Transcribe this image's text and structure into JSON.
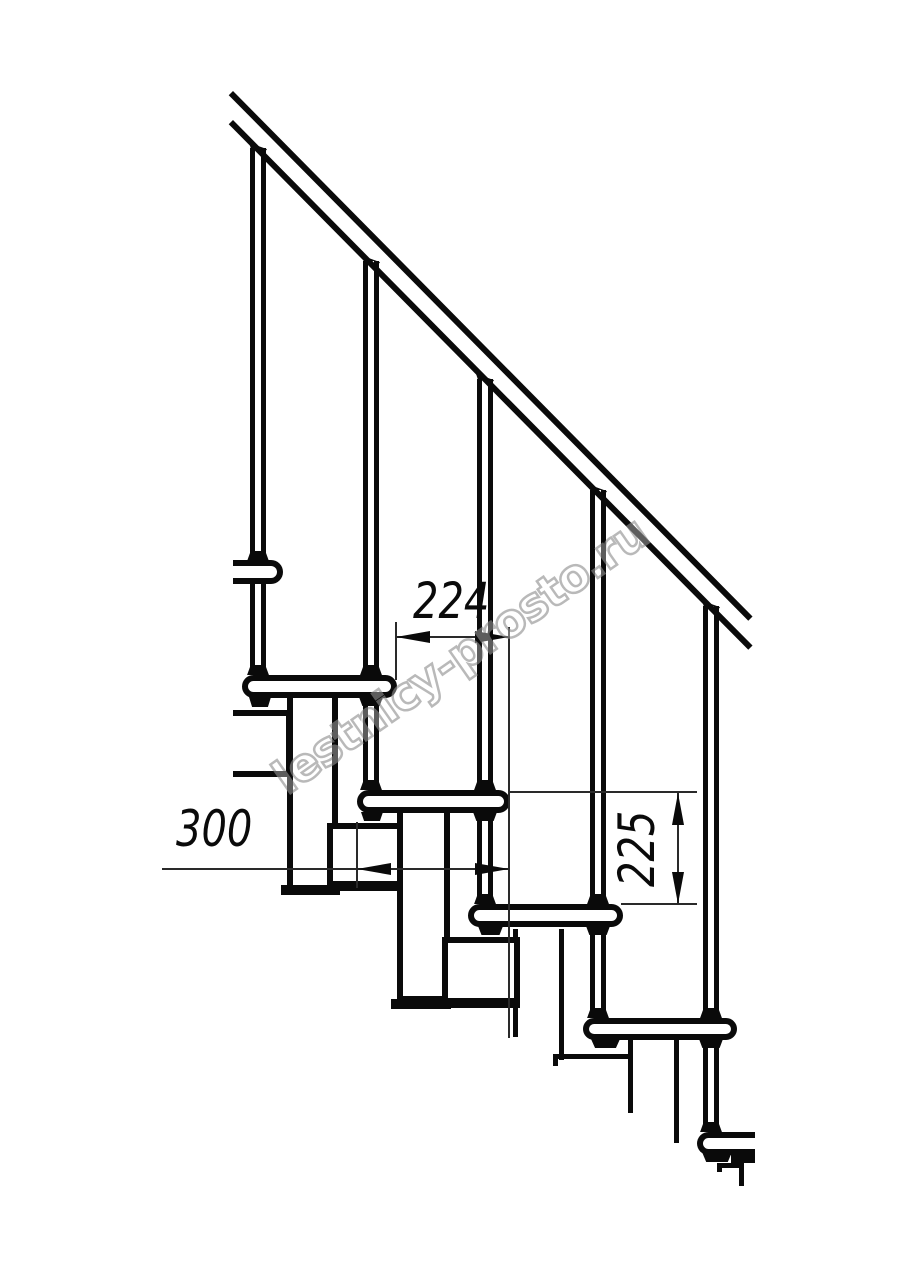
{
  "drawing": {
    "title": "staircase-side-elevation",
    "dimensions": {
      "tread_run": "224",
      "tread_depth": "300",
      "step_rise": "225"
    },
    "watermark": "lestnicy-prosto.ru",
    "colors": {
      "line": "#0a0a0a",
      "thin_line": "#2a2a2a",
      "watermark_stroke": "#8f8f8f",
      "background": "#ffffff"
    }
  }
}
